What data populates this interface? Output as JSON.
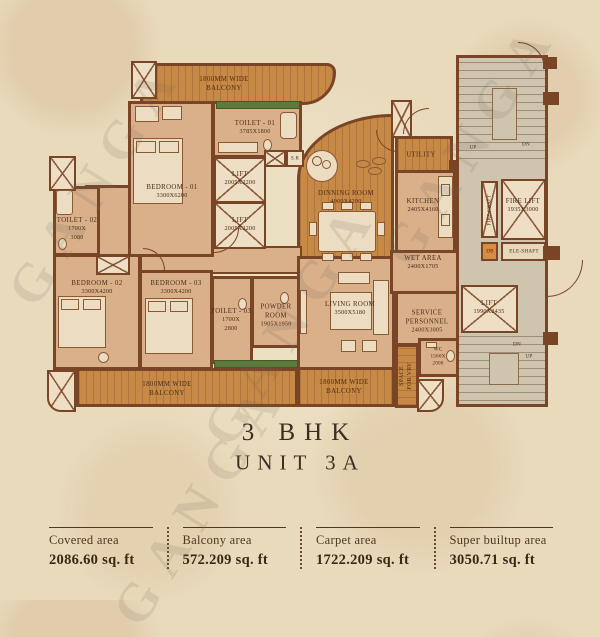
{
  "watermark": "GANGA",
  "title": {
    "line1": "3 BHK",
    "line2": "UNIT 3A"
  },
  "plan": {
    "balcony_top": {
      "l1": "1800MM WIDE",
      "l2": "BALCONY"
    },
    "toilet1": {
      "l1": "TOILET - 01",
      "l2": "3785X1800"
    },
    "bedroom1": {
      "l1": "BEDROOM - 01",
      "l2": "3300X6200"
    },
    "lift_a": {
      "l1": "LIFT",
      "l2": "2005X2200"
    },
    "lift_b": {
      "l1": "LIFT",
      "l2": "2005X2200"
    },
    "sr": "S.R",
    "toilet2": {
      "l1": "TOILET - 02",
      "l2": "1700X",
      "l3": "3080"
    },
    "bedroom2": {
      "l1": "BEDROOM - 02",
      "l2": "3300X4200"
    },
    "bedroom3": {
      "l1": "BEDROOM - 03",
      "l2": "3300X4200"
    },
    "toilet3": {
      "l1": "TOILET - 03",
      "l2": "1700X",
      "l3": "2800"
    },
    "powder": {
      "l1": "POWDER",
      "l2": "ROOM",
      "l3": "1905X1950"
    },
    "balcony_bl": {
      "l1": "1800MM WIDE",
      "l2": "BALCONY"
    },
    "balcony_br": {
      "l1": "1800MM WIDE",
      "l2": "BALCONY"
    },
    "dining": {
      "l1": "DINNING ROOM",
      "l2": "4000X4200"
    },
    "utility": {
      "l1": "UTILITY"
    },
    "kitchen": {
      "l1": "KITCHEN",
      "l2": "2405X4160"
    },
    "wet": {
      "l1": "WET AREA",
      "l2": "2400X1705"
    },
    "living": {
      "l1": "LIVING ROOM",
      "l2": "3500X5180"
    },
    "service": {
      "l1": "SERVICE",
      "l2": "PERSONNEL",
      "l3": "2400X3005"
    },
    "wc": {
      "l1": "WC",
      "l2": "1560X",
      "l3": "2000"
    },
    "vrv": {
      "l1": "SPACE",
      "l2": "FOR VRV"
    },
    "fire_lift": {
      "l1": "FIRE LIFT",
      "l2": "1935X3000"
    },
    "fire_shaft": "FIRE SHAFT",
    "db": "DB",
    "ele_shaft": "ELE-SHAFT",
    "stairs_top": {
      "up": "UP",
      "dn": "DN"
    },
    "stairs_bottom": {
      "up": "UP",
      "dn": "DN"
    },
    "lift_c": {
      "l1": "LIFT",
      "l2": "1990X2435"
    }
  },
  "stats": {
    "items": [
      {
        "label": "Covered area",
        "value": "2086.60 sq. ft"
      },
      {
        "label": "Balcony area",
        "value": "572.209 sq. ft"
      },
      {
        "label": "Carpet area",
        "value": "1722.209 sq. ft"
      },
      {
        "label": "Super builtup area",
        "value": "3050.71 sq. ft"
      }
    ]
  },
  "colors": {
    "wall": "#7a4527",
    "deck": "#c78946",
    "room": "#d9b08a",
    "core": "#cfc5ae",
    "planter_green": "#5d7a3a",
    "paper": "#e9dabc",
    "ink": "#4a2c16"
  }
}
